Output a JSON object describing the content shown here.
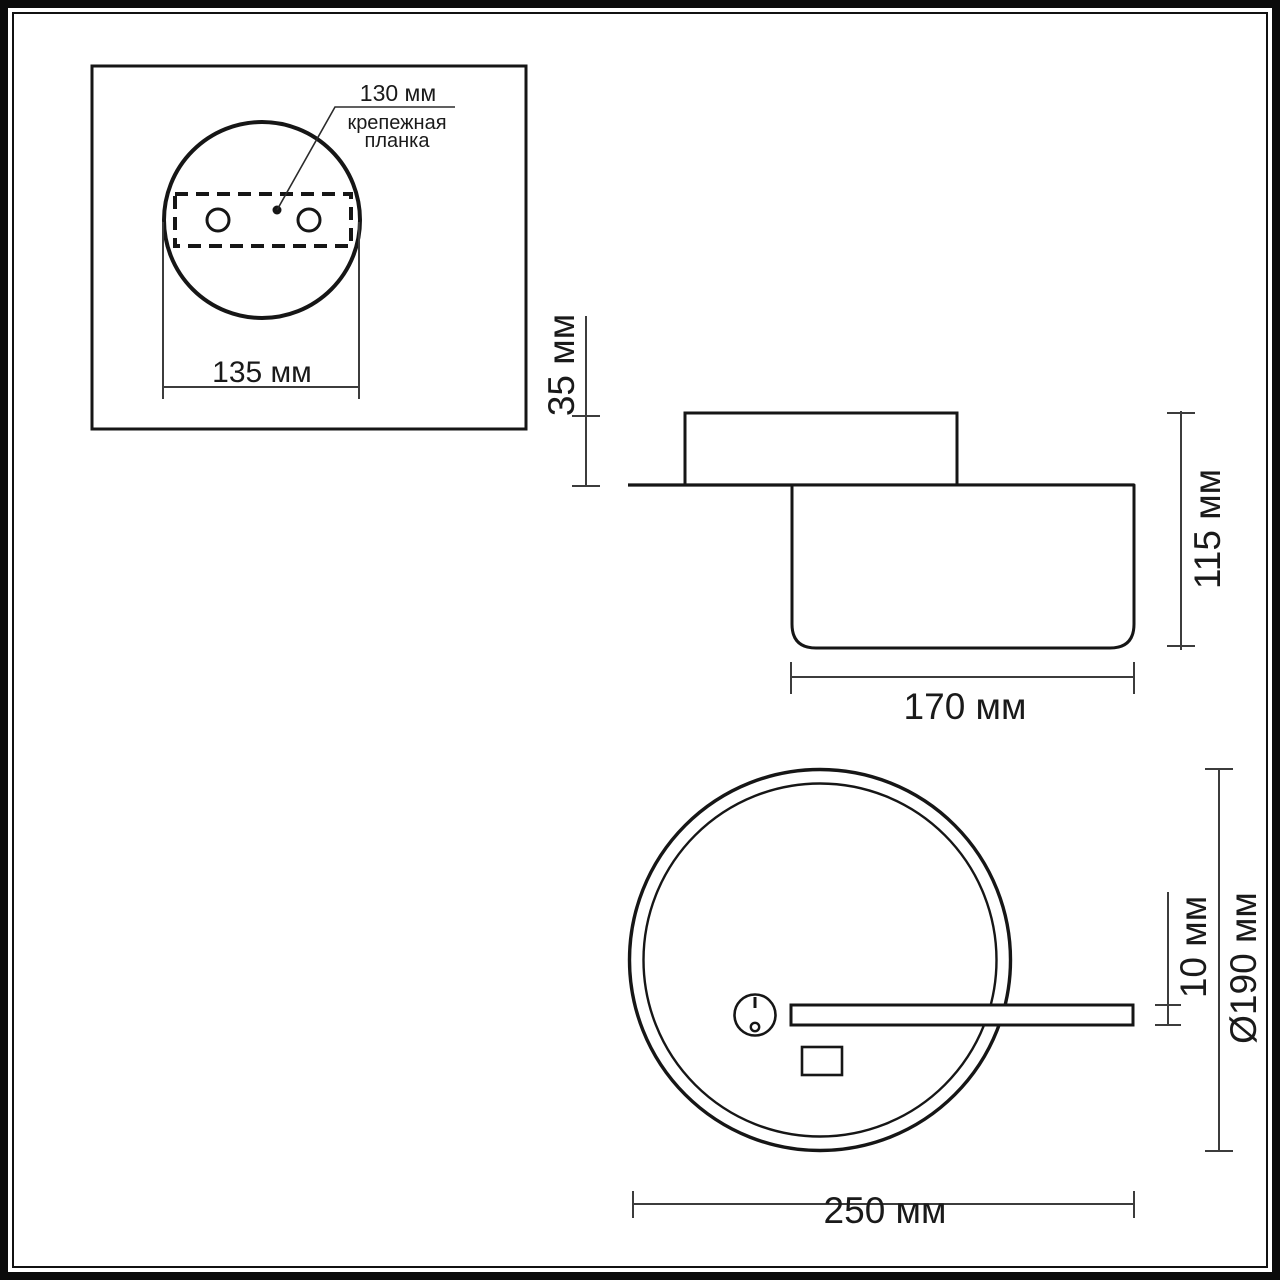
{
  "colors": {
    "ink": "#1a1a1a",
    "thin_line": "#3c3c3c",
    "background": "#ffffff"
  },
  "detail_inset": {
    "hole_spacing_label": "130 мм",
    "mount_plate_label_line1": "крепежная",
    "mount_plate_label_line2": "планка",
    "plate_width_label": "135 мм"
  },
  "side_view": {
    "canopy_depth_label": "35 мм",
    "overall_depth_label": "115 мм",
    "body_width_label": "170 мм"
  },
  "front_view": {
    "bar_thickness_label": "10 мм",
    "ring_diameter_label": "Ø190 мм",
    "overall_width_label": "250 мм"
  }
}
